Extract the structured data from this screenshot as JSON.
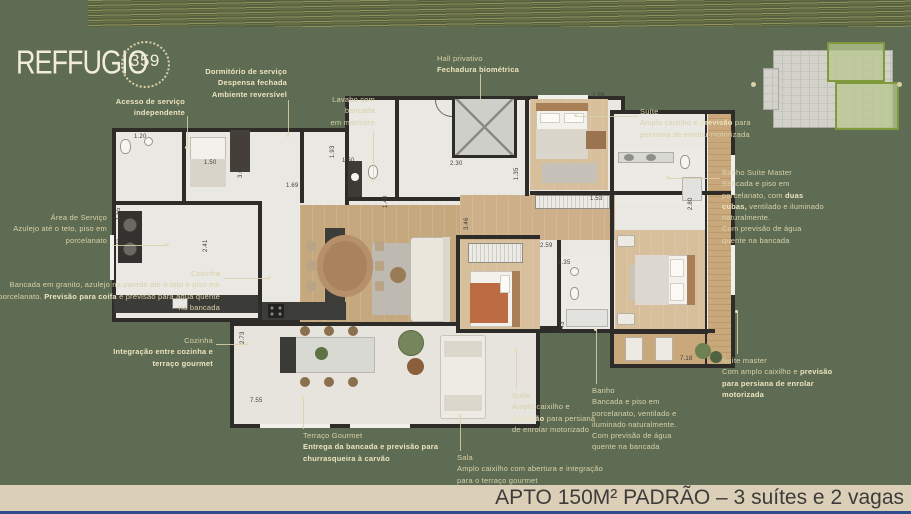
{
  "logo": {
    "brand": "REFFUGIO",
    "number": "359"
  },
  "bottom_bar": {
    "title": "APTO 150M² PADRÃO – 3 suítes e 2 vagas"
  },
  "colors": {
    "background": "#5e6c53",
    "label_text": "#d8d1aa",
    "label_bold": "#ece4bf",
    "wall": "#2d2c29",
    "wood_floor": "#c6a87e",
    "bar_background": "#dbcfb7",
    "bar_text": "#3d3c3a",
    "bottom_strip_blue": "#2d4e8e",
    "keyplan_highlight": "#7e9a3c"
  },
  "callouts": [
    {
      "id": "acesso-servico",
      "align": "right",
      "x": 185,
      "y": 96,
      "lines": [
        [
          {
            "t": "Acesso de serviço",
            "b": true
          }
        ],
        [
          {
            "t": "independente",
            "b": true
          }
        ]
      ]
    },
    {
      "id": "dormitorio-servico",
      "align": "right",
      "x": 287,
      "y": 66,
      "lines": [
        [
          {
            "t": "Dormitório de serviço",
            "b": true
          }
        ],
        [
          {
            "t": "Despensa fechada",
            "b": true
          }
        ],
        [
          {
            "t": "Ambiente reversível",
            "b": true
          }
        ]
      ]
    },
    {
      "id": "lavabo",
      "align": "right",
      "x": 375,
      "y": 94,
      "lines": [
        [
          {
            "t": "Lavabo com"
          }
        ],
        [
          {
            "t": "bancada"
          }
        ],
        [
          {
            "t": "em mármore"
          }
        ]
      ]
    },
    {
      "id": "hall-privativo",
      "align": "left",
      "x": 437,
      "y": 53,
      "lines": [
        [
          {
            "t": "Hall privativo"
          }
        ],
        [
          {
            "t": "Fechadura biométrica",
            "b": true
          }
        ]
      ]
    },
    {
      "id": "suite",
      "align": "left",
      "x": 640,
      "y": 106,
      "lines": [
        [
          {
            "t": "Suíte"
          }
        ],
        [
          {
            "t": "Amplo caixilho e "
          },
          {
            "t": "previsão",
            "b": true
          },
          {
            "t": " para"
          }
        ],
        [
          {
            "t": "persiana de enrolar motorizada"
          }
        ]
      ]
    },
    {
      "id": "banho-suite-master",
      "align": "left",
      "x": 722,
      "y": 167,
      "lines": [
        [
          {
            "t": "Banho Suíte Master"
          }
        ],
        [
          {
            "t": "Bancada e piso em"
          }
        ],
        [
          {
            "t": "porcelanato, com "
          },
          {
            "t": "duas",
            "b": true
          }
        ],
        [
          {
            "t": "cubas,",
            "b": true
          },
          {
            "t": " ventilado e iluminado"
          }
        ],
        [
          {
            "t": "naturalmente."
          }
        ],
        [
          {
            "t": "Com previsão de água"
          }
        ],
        [
          {
            "t": "quente na bancada"
          }
        ]
      ]
    },
    {
      "id": "suite-master",
      "align": "left",
      "x": 722,
      "y": 355,
      "lines": [
        [
          {
            "t": "Suíte master"
          }
        ],
        [
          {
            "t": "Com amplo caixilho e "
          },
          {
            "t": "previsão",
            "b": true
          }
        ],
        [
          {
            "t": "para persiana de enrolar",
            "b": true
          }
        ],
        [
          {
            "t": "motorizada",
            "b": true
          }
        ]
      ]
    },
    {
      "id": "suite-2",
      "align": "left",
      "x": 512,
      "y": 390,
      "lines": [
        [
          {
            "t": "Suíte"
          }
        ],
        [
          {
            "t": "Amplo caixilho e"
          }
        ],
        [
          {
            "t": "previsão",
            "b": true
          },
          {
            "t": " para persiana"
          }
        ],
        [
          {
            "t": "de enrolar motorizado"
          }
        ]
      ]
    },
    {
      "id": "banho",
      "align": "left",
      "x": 592,
      "y": 385,
      "lines": [
        [
          {
            "t": "Banho"
          }
        ],
        [
          {
            "t": "Bancada e piso em"
          }
        ],
        [
          {
            "t": "porcelanato, ventilado e"
          }
        ],
        [
          {
            "t": "iluminado naturalmente."
          }
        ],
        [
          {
            "t": "Com previsão de água"
          }
        ],
        [
          {
            "t": "quente na bancada"
          }
        ]
      ]
    },
    {
      "id": "sala",
      "align": "left",
      "x": 457,
      "y": 452,
      "lines": [
        [
          {
            "t": "Sala"
          }
        ],
        [
          {
            "t": "Amplo caixilho com abertura e integração"
          }
        ],
        [
          {
            "t": "para o terraço gourmet"
          }
        ]
      ]
    },
    {
      "id": "terraco-gourmet",
      "align": "left",
      "x": 303,
      "y": 430,
      "lines": [
        [
          {
            "t": "Terraço Gourmet"
          }
        ],
        [
          {
            "t": "Entrega da bancada e previsão para",
            "b": true
          }
        ],
        [
          {
            "t": "churrasqueira à carvão",
            "b": true
          }
        ]
      ]
    },
    {
      "id": "cozinha-integracao",
      "align": "right",
      "x": 213,
      "y": 335,
      "lines": [
        [
          {
            "t": "Cozinha"
          }
        ],
        [
          {
            "t": "Integração entre cozinha e",
            "b": true
          }
        ],
        [
          {
            "t": "terraço gourmet",
            "b": true
          }
        ]
      ]
    },
    {
      "id": "cozinha",
      "align": "right",
      "x": 220,
      "y": 268,
      "lines": [
        [
          {
            "t": "Cozinha"
          }
        ],
        [
          {
            "t": "Bancada em granito, azulejo na parede até o teto e piso em"
          }
        ],
        [
          {
            "t": "porcelanato. "
          },
          {
            "t": "Previsão para coifa",
            "b": true
          },
          {
            "t": " e previsão para água quente"
          }
        ],
        [
          {
            "t": "na bancada"
          }
        ]
      ]
    },
    {
      "id": "area-servico",
      "align": "right",
      "x": 107,
      "y": 212,
      "lines": [
        [
          {
            "t": "Área de Serviço"
          }
        ],
        [
          {
            "t": "Azulejo até o teto, piso em"
          }
        ],
        [
          {
            "t": "porcelanato"
          }
        ]
      ]
    }
  ],
  "dimensions": [
    {
      "t": "1.20",
      "x": 134,
      "y": 134
    },
    {
      "t": "3.09",
      "x": 238,
      "y": 178,
      "r": 1
    },
    {
      "t": "1.50",
      "x": 204,
      "y": 160
    },
    {
      "t": "1.69",
      "x": 286,
      "y": 183
    },
    {
      "t": "1.93",
      "x": 330,
      "y": 158,
      "r": 1
    },
    {
      "t": "1.50",
      "x": 342,
      "y": 158
    },
    {
      "t": "1.40",
      "x": 383,
      "y": 208,
      "r": 1
    },
    {
      "t": "1.55",
      "x": 116,
      "y": 220,
      "r": 1
    },
    {
      "t": "3.01",
      "x": 116,
      "y": 240
    },
    {
      "t": "2.41",
      "x": 203,
      "y": 252,
      "r": 1
    },
    {
      "t": "2.30",
      "x": 450,
      "y": 161
    },
    {
      "t": "1.35",
      "x": 514,
      "y": 180,
      "r": 1
    },
    {
      "t": "2.99",
      "x": 592,
      "y": 93
    },
    {
      "t": "1.53",
      "x": 590,
      "y": 196
    },
    {
      "t": "3.46",
      "x": 464,
      "y": 230,
      "r": 1
    },
    {
      "t": "2.59",
      "x": 540,
      "y": 243
    },
    {
      "t": "1.35",
      "x": 558,
      "y": 260
    },
    {
      "t": "2.80",
      "x": 688,
      "y": 210,
      "r": 1
    },
    {
      "t": "2.43",
      "x": 560,
      "y": 334,
      "r": 1
    },
    {
      "t": "7.18",
      "x": 680,
      "y": 356
    },
    {
      "t": "2.37",
      "x": 248,
      "y": 308
    },
    {
      "t": "5.36",
      "x": 294,
      "y": 308
    },
    {
      "t": "2.73",
      "x": 240,
      "y": 344,
      "r": 1
    },
    {
      "t": "7.55",
      "x": 250,
      "y": 398
    },
    {
      "t": "3.81",
      "x": 296,
      "y": 314,
      "r": 1
    }
  ]
}
